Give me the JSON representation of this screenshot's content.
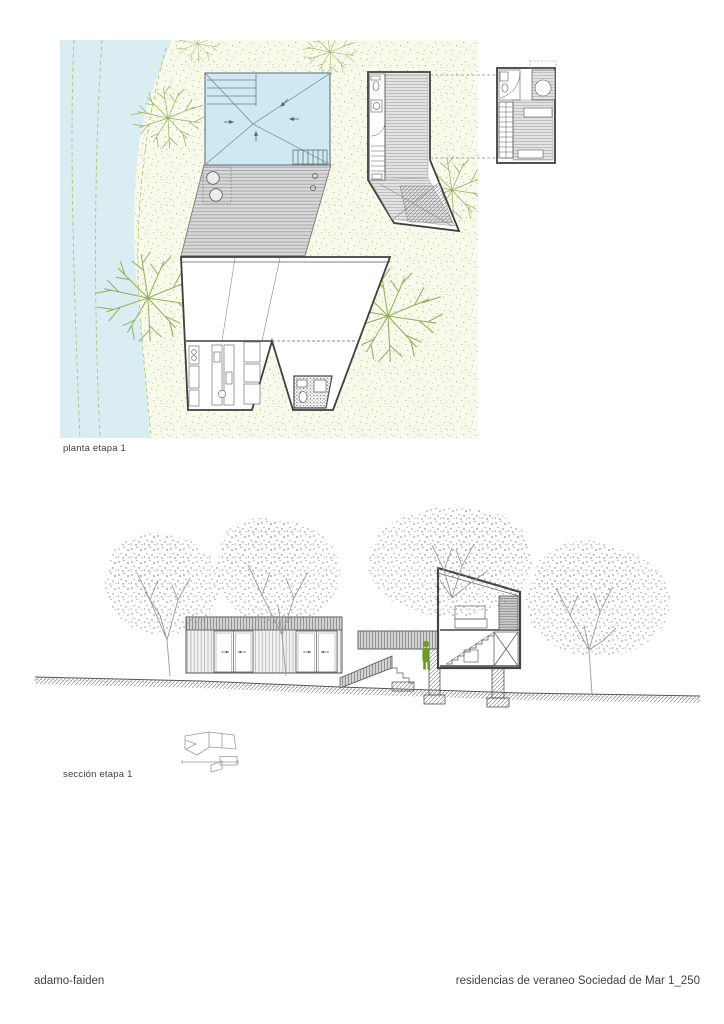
{
  "sheet": {
    "figures": [
      {
        "id": "plan",
        "caption": "planta etapa 1"
      },
      {
        "id": "section",
        "caption": "sección etapa 1"
      }
    ],
    "footer": {
      "studio": "adamo-faiden",
      "project_title": "residencias de veraneo Sociedad de Mar 1_250"
    }
  },
  "colors": {
    "paper": "#ffffff",
    "ink": "#3f3f3f",
    "line_mid": "#6f6f6f",
    "line_light": "#9a9a9a",
    "river_blue": "#d9edf2",
    "pool_blue": "#cfe8f2",
    "pool_line": "#5f7880",
    "vegetation_bg": "#f8faeb",
    "vegetation_dot": "#b9cd84",
    "tree_green": "#93b163",
    "contour_green": "#a9c06c",
    "deck_gray": "#d8d8d8",
    "deck_line": "#9f9f9f",
    "figure_green": "#6d9b2a"
  }
}
